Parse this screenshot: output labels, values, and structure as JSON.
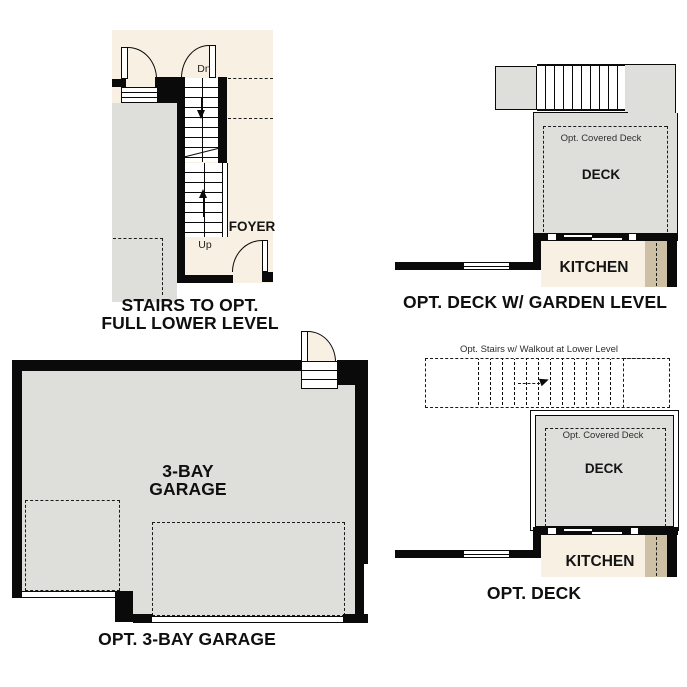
{
  "colors": {
    "wall": "#0a0a0a",
    "floor_gray": "#dededa",
    "cream": "#f8f1e3",
    "tan": "#cdc0a4"
  },
  "stairs_fig": {
    "dn_label": "Dn",
    "up_label": "Up",
    "foyer_label": "FOYER",
    "caption_line1": "STAIRS TO OPT.",
    "caption_line2": "FULL LOWER LEVEL"
  },
  "garden_deck_fig": {
    "covered_deck_label": "Opt. Covered Deck",
    "deck_label": "DECK",
    "kitchen_label": "KITCHEN",
    "caption": "OPT. DECK W/ GARDEN LEVEL"
  },
  "garage_fig": {
    "label_line1": "3-BAY",
    "label_line2": "GARAGE",
    "caption": "OPT. 3-BAY GARAGE"
  },
  "deck_fig": {
    "stairs_note": "Opt. Stairs w/ Walkout at Lower Level",
    "covered_deck_label": "Opt. Covered Deck",
    "deck_label": "DECK",
    "kitchen_label": "KITCHEN",
    "caption": "OPT. DECK"
  }
}
